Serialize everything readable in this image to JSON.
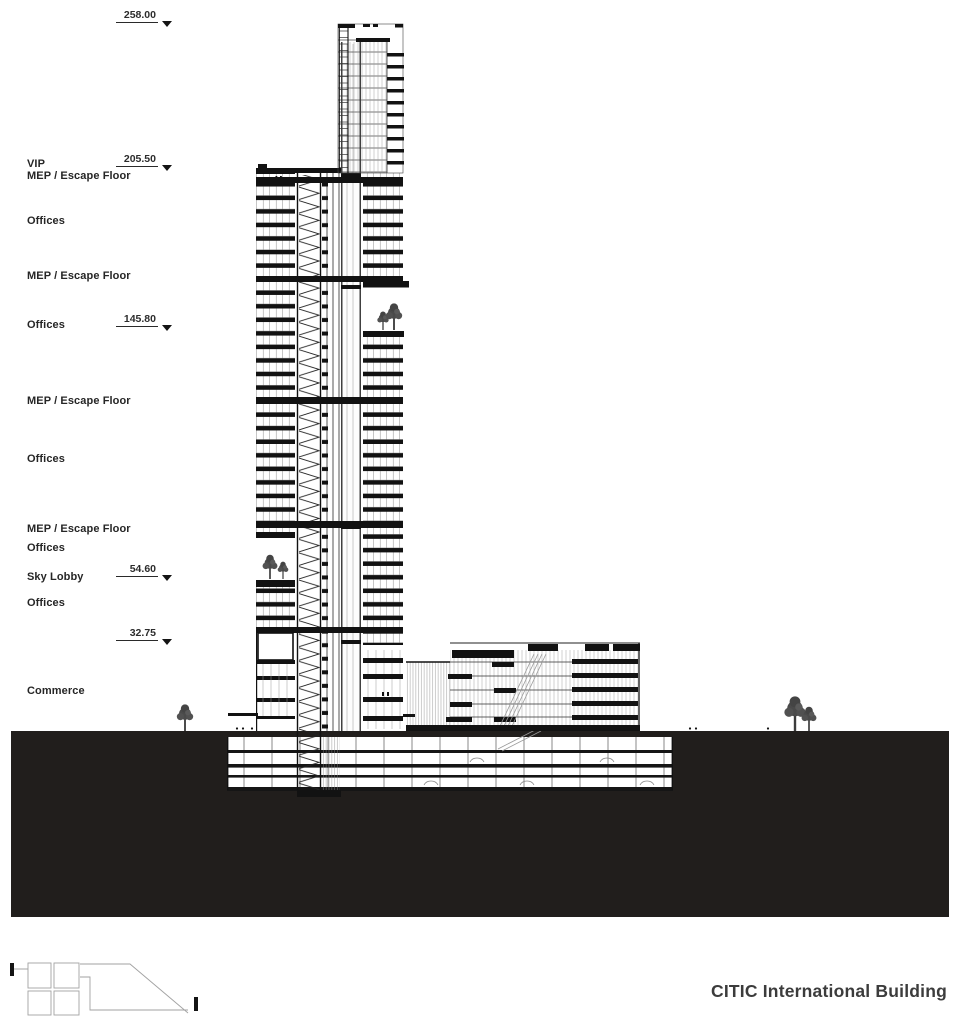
{
  "title": "CITIC International Building",
  "colors": {
    "ink": "#1a1a1a",
    "ground_mass": "#211e1c",
    "label_text": "#262626"
  },
  "elevation_markers": [
    {
      "value": "258.00",
      "unit": "m"
    },
    {
      "value": "205.50",
      "unit": "m"
    },
    {
      "value": "145.80",
      "unit": "m"
    },
    {
      "value": "54.60",
      "unit": "m"
    },
    {
      "value": "32.75",
      "unit": "m"
    }
  ],
  "floor_labels": [
    {
      "text": "VIP"
    },
    {
      "text": "MEP / Escape Floor"
    },
    {
      "text": "Offices"
    },
    {
      "text": "MEP / Escape Floor"
    },
    {
      "text": "Offices"
    },
    {
      "text": "MEP / Escape Floor"
    },
    {
      "text": "Offices"
    },
    {
      "text": "MEP / Escape Floor"
    },
    {
      "text": "Offices"
    },
    {
      "text": "Sky Lobby"
    },
    {
      "text": "Offices"
    },
    {
      "text": "Commerce"
    }
  ]
}
